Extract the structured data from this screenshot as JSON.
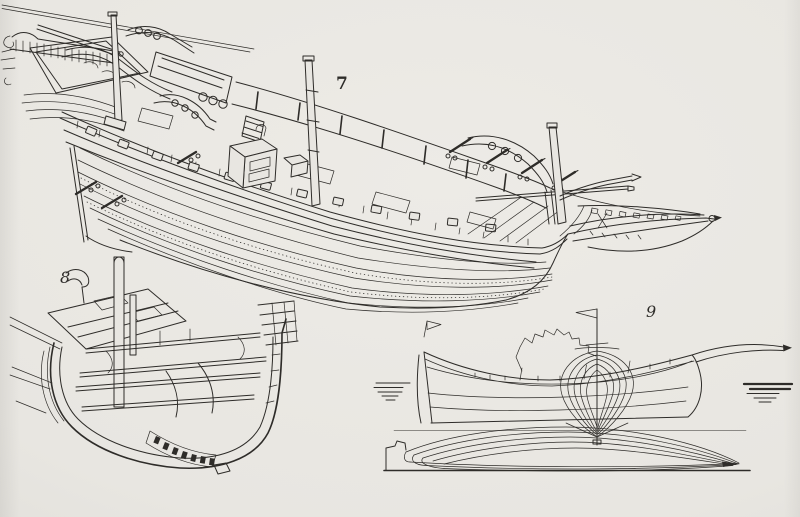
{
  "page": {
    "background": "#e8e6e1",
    "ink": "#2e2c29",
    "kind": "engraved plate of three ship drawings"
  },
  "figures": [
    {
      "id": "fig7",
      "label": "7"
    },
    {
      "id": "fig8",
      "label": "8"
    },
    {
      "id": "fig9",
      "label": "9"
    }
  ]
}
